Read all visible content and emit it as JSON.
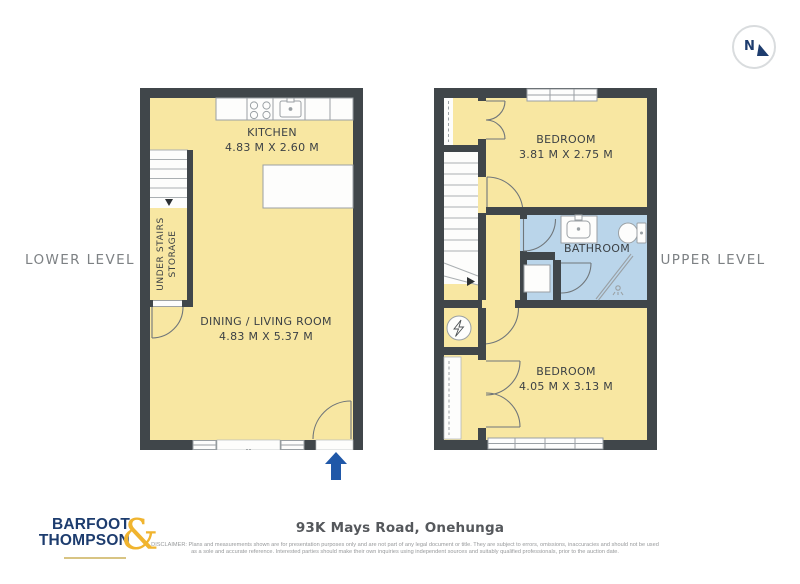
{
  "compass": {
    "label": "N"
  },
  "lower": {
    "label": "LOWER LEVEL",
    "kitchen_name": "KITCHEN",
    "kitchen_dims": "4.83 M X 2.60 M",
    "living_name": "DINING / LIVING ROOM",
    "living_dims": "4.83 M X 5.37 M",
    "storage_line1": "UNDER STAIRS",
    "storage_line2": "STORAGE"
  },
  "upper": {
    "label": "UPPER LEVEL",
    "bedroom1_name": "BEDROOM",
    "bedroom1_dims": "3.81 M X 2.75 M",
    "bathroom_name": "BATHROOM",
    "bedroom2_name": "BEDROOM",
    "bedroom2_dims": "4.05 M X 3.13 M"
  },
  "footer": {
    "brand_line1": "BARFOOT",
    "brand_line2": "THOMPSON",
    "brand_amp": "&",
    "address": "93K Mays Road, Onehunga",
    "disclaimer_line1": "DISCLAIMER: Plans and measurements shown are for presentation purposes only and are not part of any legal document or title. They are subject to errors, omissions, inaccuracies and should not be used",
    "disclaimer_line2": "as a sole and accurate reference. Interested parties should make their own inquiries using independent sources and suitably qualified professionals, prior to the auction date."
  },
  "colors": {
    "wall": "#40464a",
    "room_yellow": "#f8e7a2",
    "bathroom_blue": "#bad5ea",
    "accent_blue": "#2058a8",
    "brand_navy": "#1d3c6e",
    "brand_gold": "#f0b42f"
  }
}
